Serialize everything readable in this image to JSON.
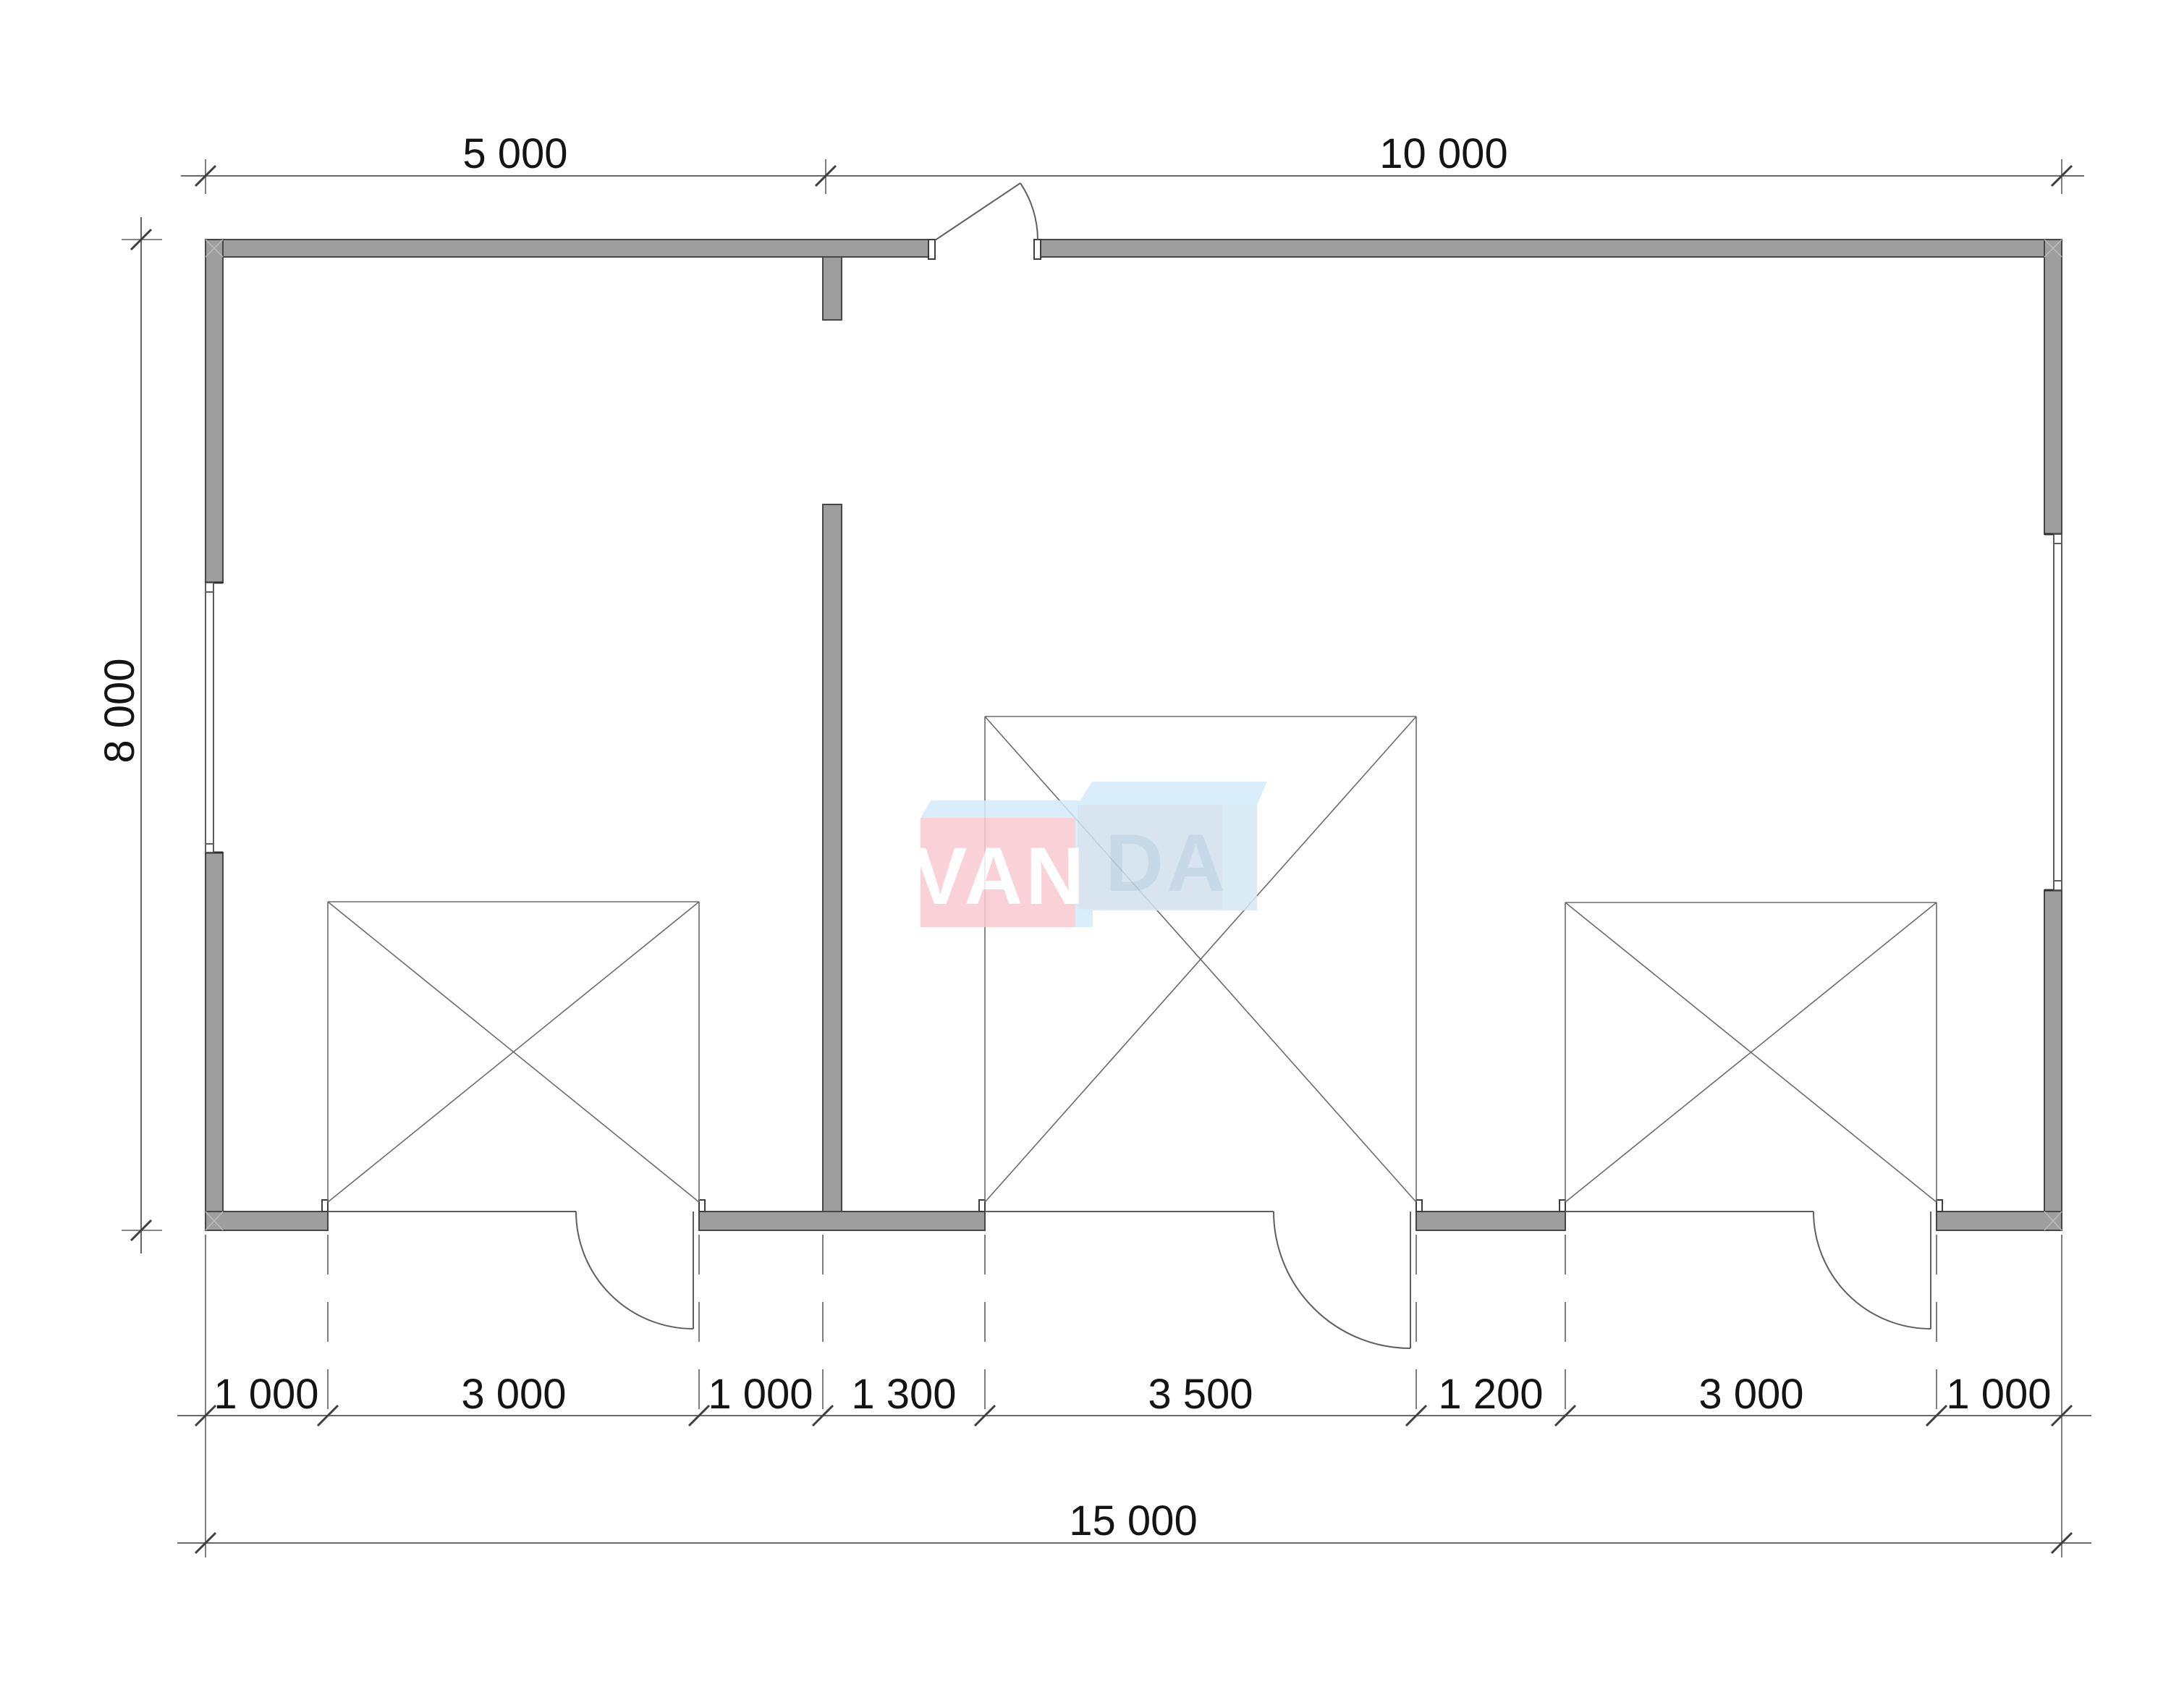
{
  "document": {
    "type": "architectural floor plan drawing",
    "background": "#ffffff"
  },
  "dimensions": {
    "top": [
      {
        "label": "5 000"
      },
      {
        "label": "10 000"
      }
    ],
    "left": [
      {
        "label": "8 000"
      }
    ],
    "bottom": [
      {
        "label": "1 000"
      },
      {
        "label": "3 000"
      },
      {
        "label": "1 000"
      },
      {
        "label": "1 300"
      },
      {
        "label": "3 500"
      },
      {
        "label": "1 200"
      },
      {
        "label": "3 000"
      },
      {
        "label": "1 000"
      }
    ],
    "overall": [
      {
        "label": "15 000"
      }
    ]
  },
  "watermark": {
    "full": "VANDA",
    "text_left": "VAN",
    "text_right": "DA"
  },
  "colors": {
    "wall_fill": "#9e9e9e",
    "logo_pink": "#f8c9d0",
    "logo_blue_top": "#d4eafa",
    "logo_blue_front": "#d7e9f6",
    "logo_blue_inner": "#cdd9e7",
    "logo_letter_white": "#ffffff",
    "logo_letter_blue": "#bed3e3"
  }
}
